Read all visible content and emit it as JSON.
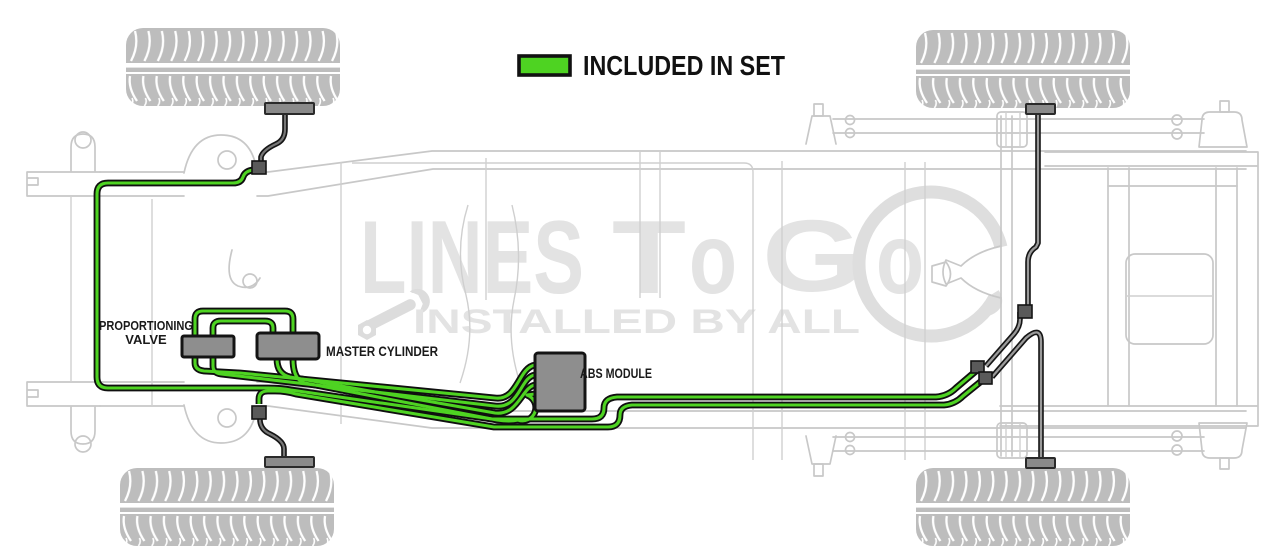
{
  "legend": {
    "label": "INCLUDED IN SET",
    "swatch_color": "#4ed322"
  },
  "component_labels": {
    "proportioning_valve_line1": "PROPORTIONING",
    "proportioning_valve_line2": "VALVE",
    "master_cylinder": "MASTER CYLINDER",
    "abs_module": "ABS MODULE"
  },
  "watermark": {
    "segments": [
      "LINES",
      "T",
      "o",
      "G",
      "o"
    ],
    "tagline": "INSTALLED BY ALL"
  },
  "colors": {
    "included_line_green": "#4ed322",
    "line_outline_black": "#0f0f0f",
    "component_gray": "#8e8e8e",
    "frame_gray": "#c8c8c8",
    "tire_gray": "#bdbdbd",
    "watermark_gray": "#e3e3e3"
  }
}
